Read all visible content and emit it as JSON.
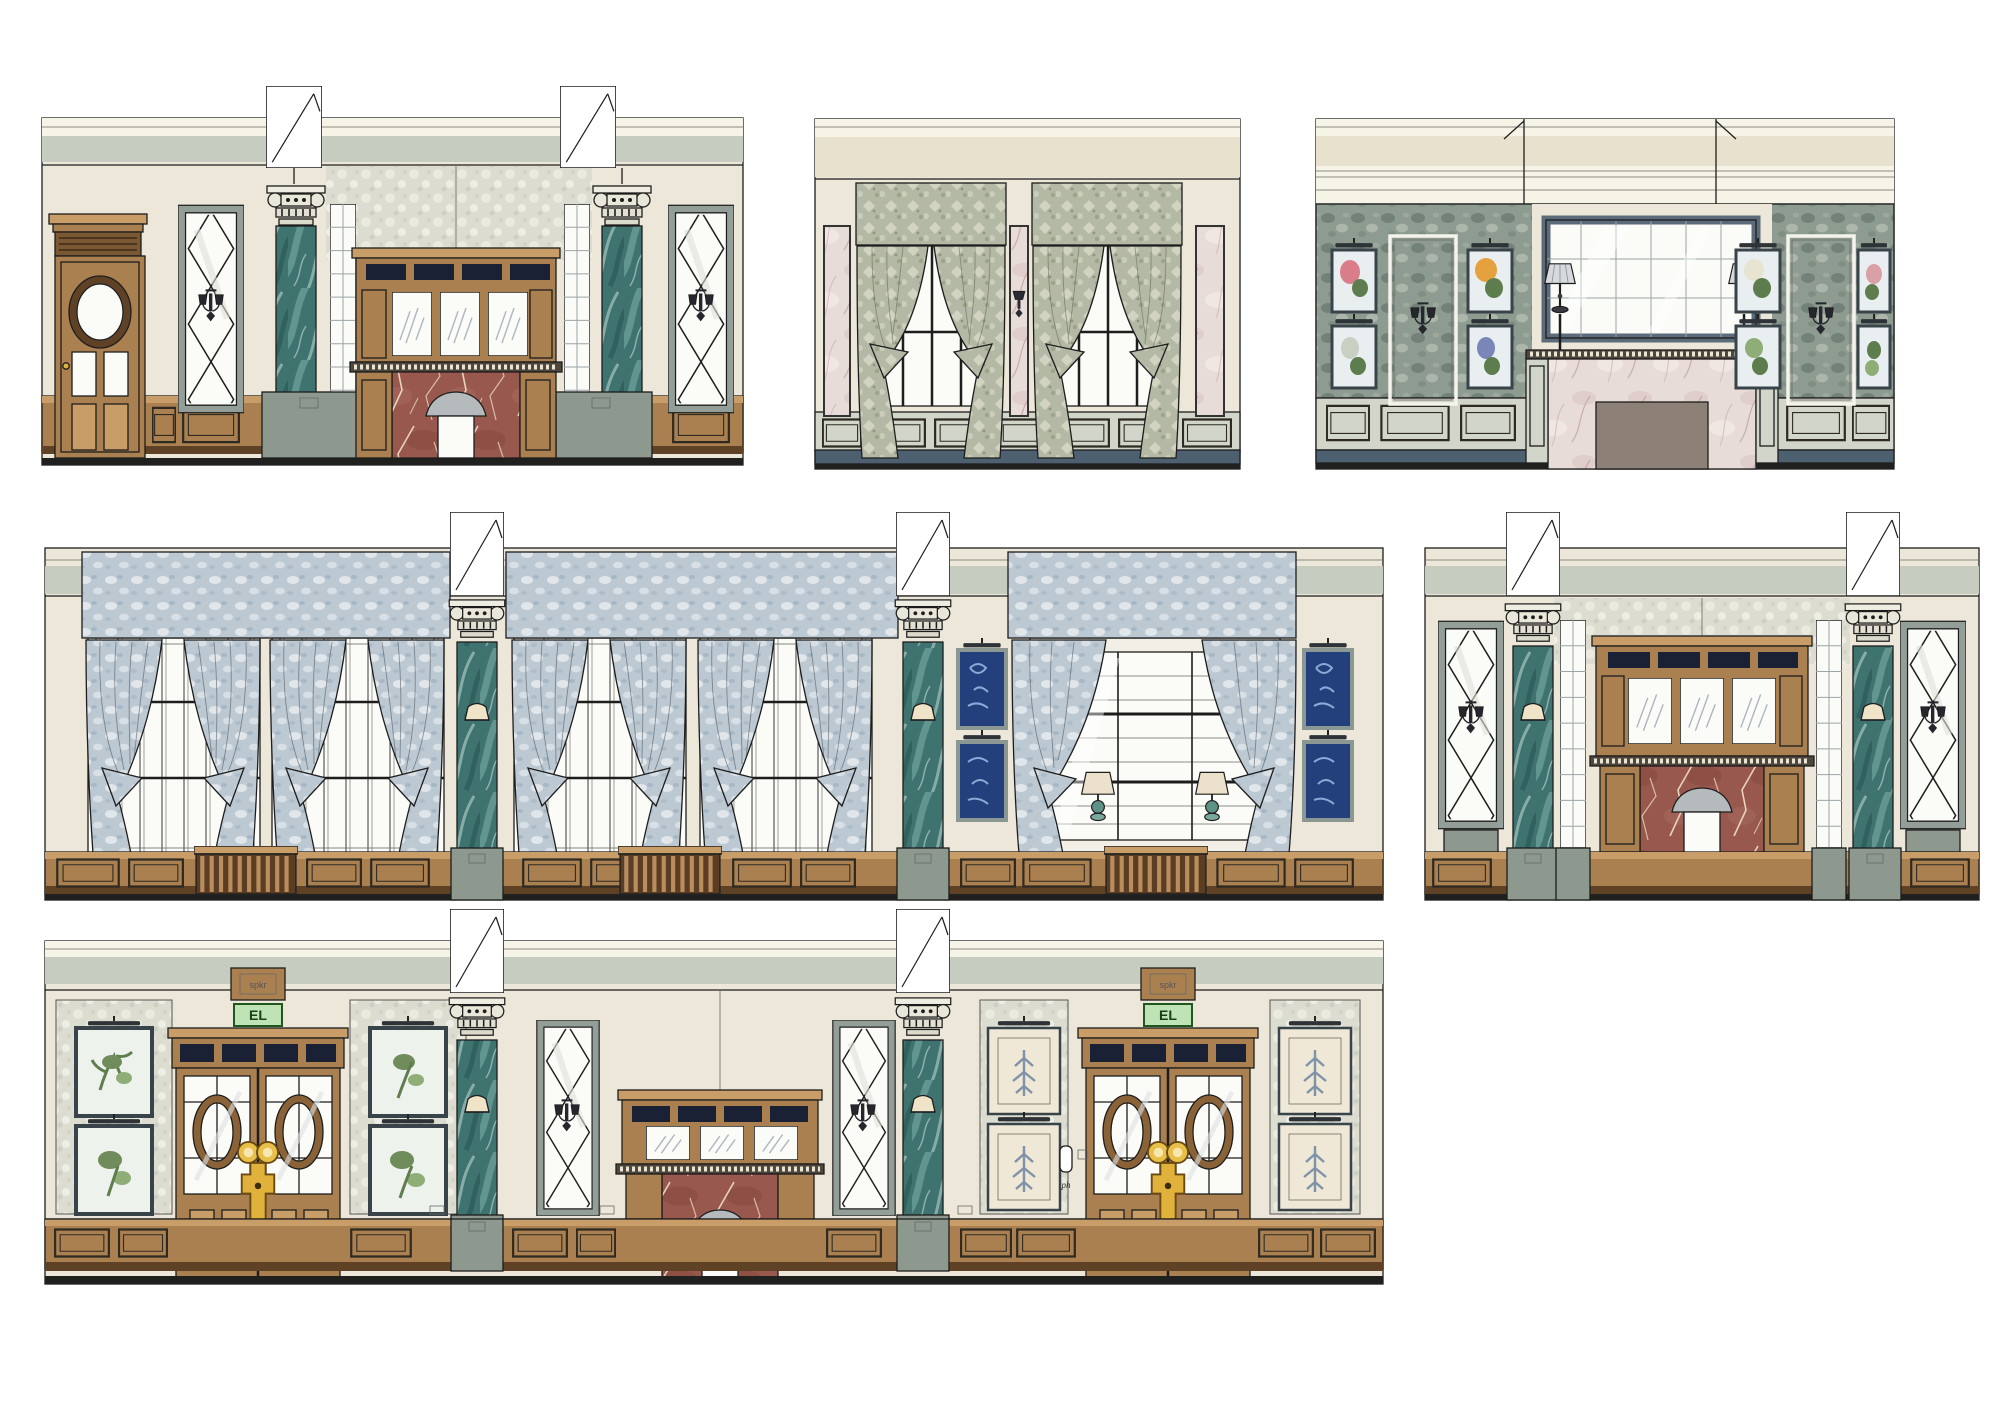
{
  "labels": {
    "elevator": "EL",
    "speaker": "spkr",
    "phone": "ph"
  },
  "palette": {
    "ink": "#1d1d1d",
    "paper": "#ffffff",
    "cream": "#ece7d8",
    "cream_light": "#f6f4e7",
    "beige": "#e8e1cd",
    "sage_band": "#c6cdc0",
    "pearl_wall": "#dcddd0",
    "fabric_sage": "#b4b9a5",
    "fabric_sheer": "#bcc8d2",
    "foliage": "#8e9b91",
    "teal_marble": "#3e7370",
    "red_marble": "#98584d",
    "pink_marble": "#e8dcd8",
    "wood_mid": "#ab8050",
    "wood_light": "#c89d68",
    "wood_dark": "#5f4226",
    "slate_base": "#4d6070",
    "slate_frame": "#5b6b7a",
    "paint_gray": "#d2d5c9",
    "pedestal_gray": "#8d988f",
    "glass": "#fbfbf7",
    "frame_gray": "#939e99",
    "gold": "#e0b23c",
    "sign_green": "#bfe3b4",
    "sign_green_border": "#20561f",
    "navy_print": "#24407c",
    "firebox_taupe": "#8d8076",
    "shade_gray": "#b5babc"
  }
}
